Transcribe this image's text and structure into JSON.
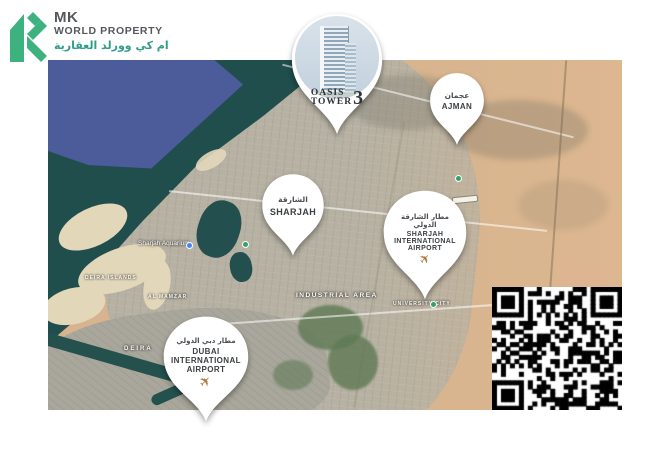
{
  "brand": {
    "initials": "MK",
    "name": "WORLD PROPERTY",
    "name_arabic": "ام كي وورلد العقارية"
  },
  "property": {
    "name_line1": "OASIS",
    "name_line2": "TOWER",
    "number": "3"
  },
  "pins": {
    "ajman": {
      "arabic": "عجمان",
      "english": "AJMAN"
    },
    "sharjah": {
      "arabic": "الشارقة",
      "english": "SHARJAH"
    },
    "sharjah_airport": {
      "arabic_line1": "مطار الشارقة",
      "arabic_line2": "الدولي",
      "english_line1": "SHARJAH",
      "english_line2": "INTERNATIONAL",
      "english_line3": "AIRPORT"
    },
    "dubai_airport": {
      "arabic": "مطار دبي الدولي",
      "english_line1": "DUBAI",
      "english_line2": "INTERNATIONAL",
      "english_line3": "AIRPORT"
    }
  },
  "map_labels": {
    "aquarium": "Sharjah Aquarium",
    "deira_islands": "DEIRA ISLANDS",
    "al_mamzar": "AL MAMZAR",
    "industrial_area": "INDUSTRIAL AREA",
    "university_city": "UNIVERSITY CITY",
    "deira": "DEIRA"
  },
  "icons": {
    "airplane": "✈"
  },
  "colors": {
    "brand_green": "#3eb27e",
    "brand_teal": "#2f9d8a",
    "airplane_gold": "#aa7a3e",
    "sea_deep": "#4c5b9a",
    "sea_shallow": "#1f4e4c",
    "desert": "#d7b48f",
    "urban": "#b6b1a2"
  }
}
